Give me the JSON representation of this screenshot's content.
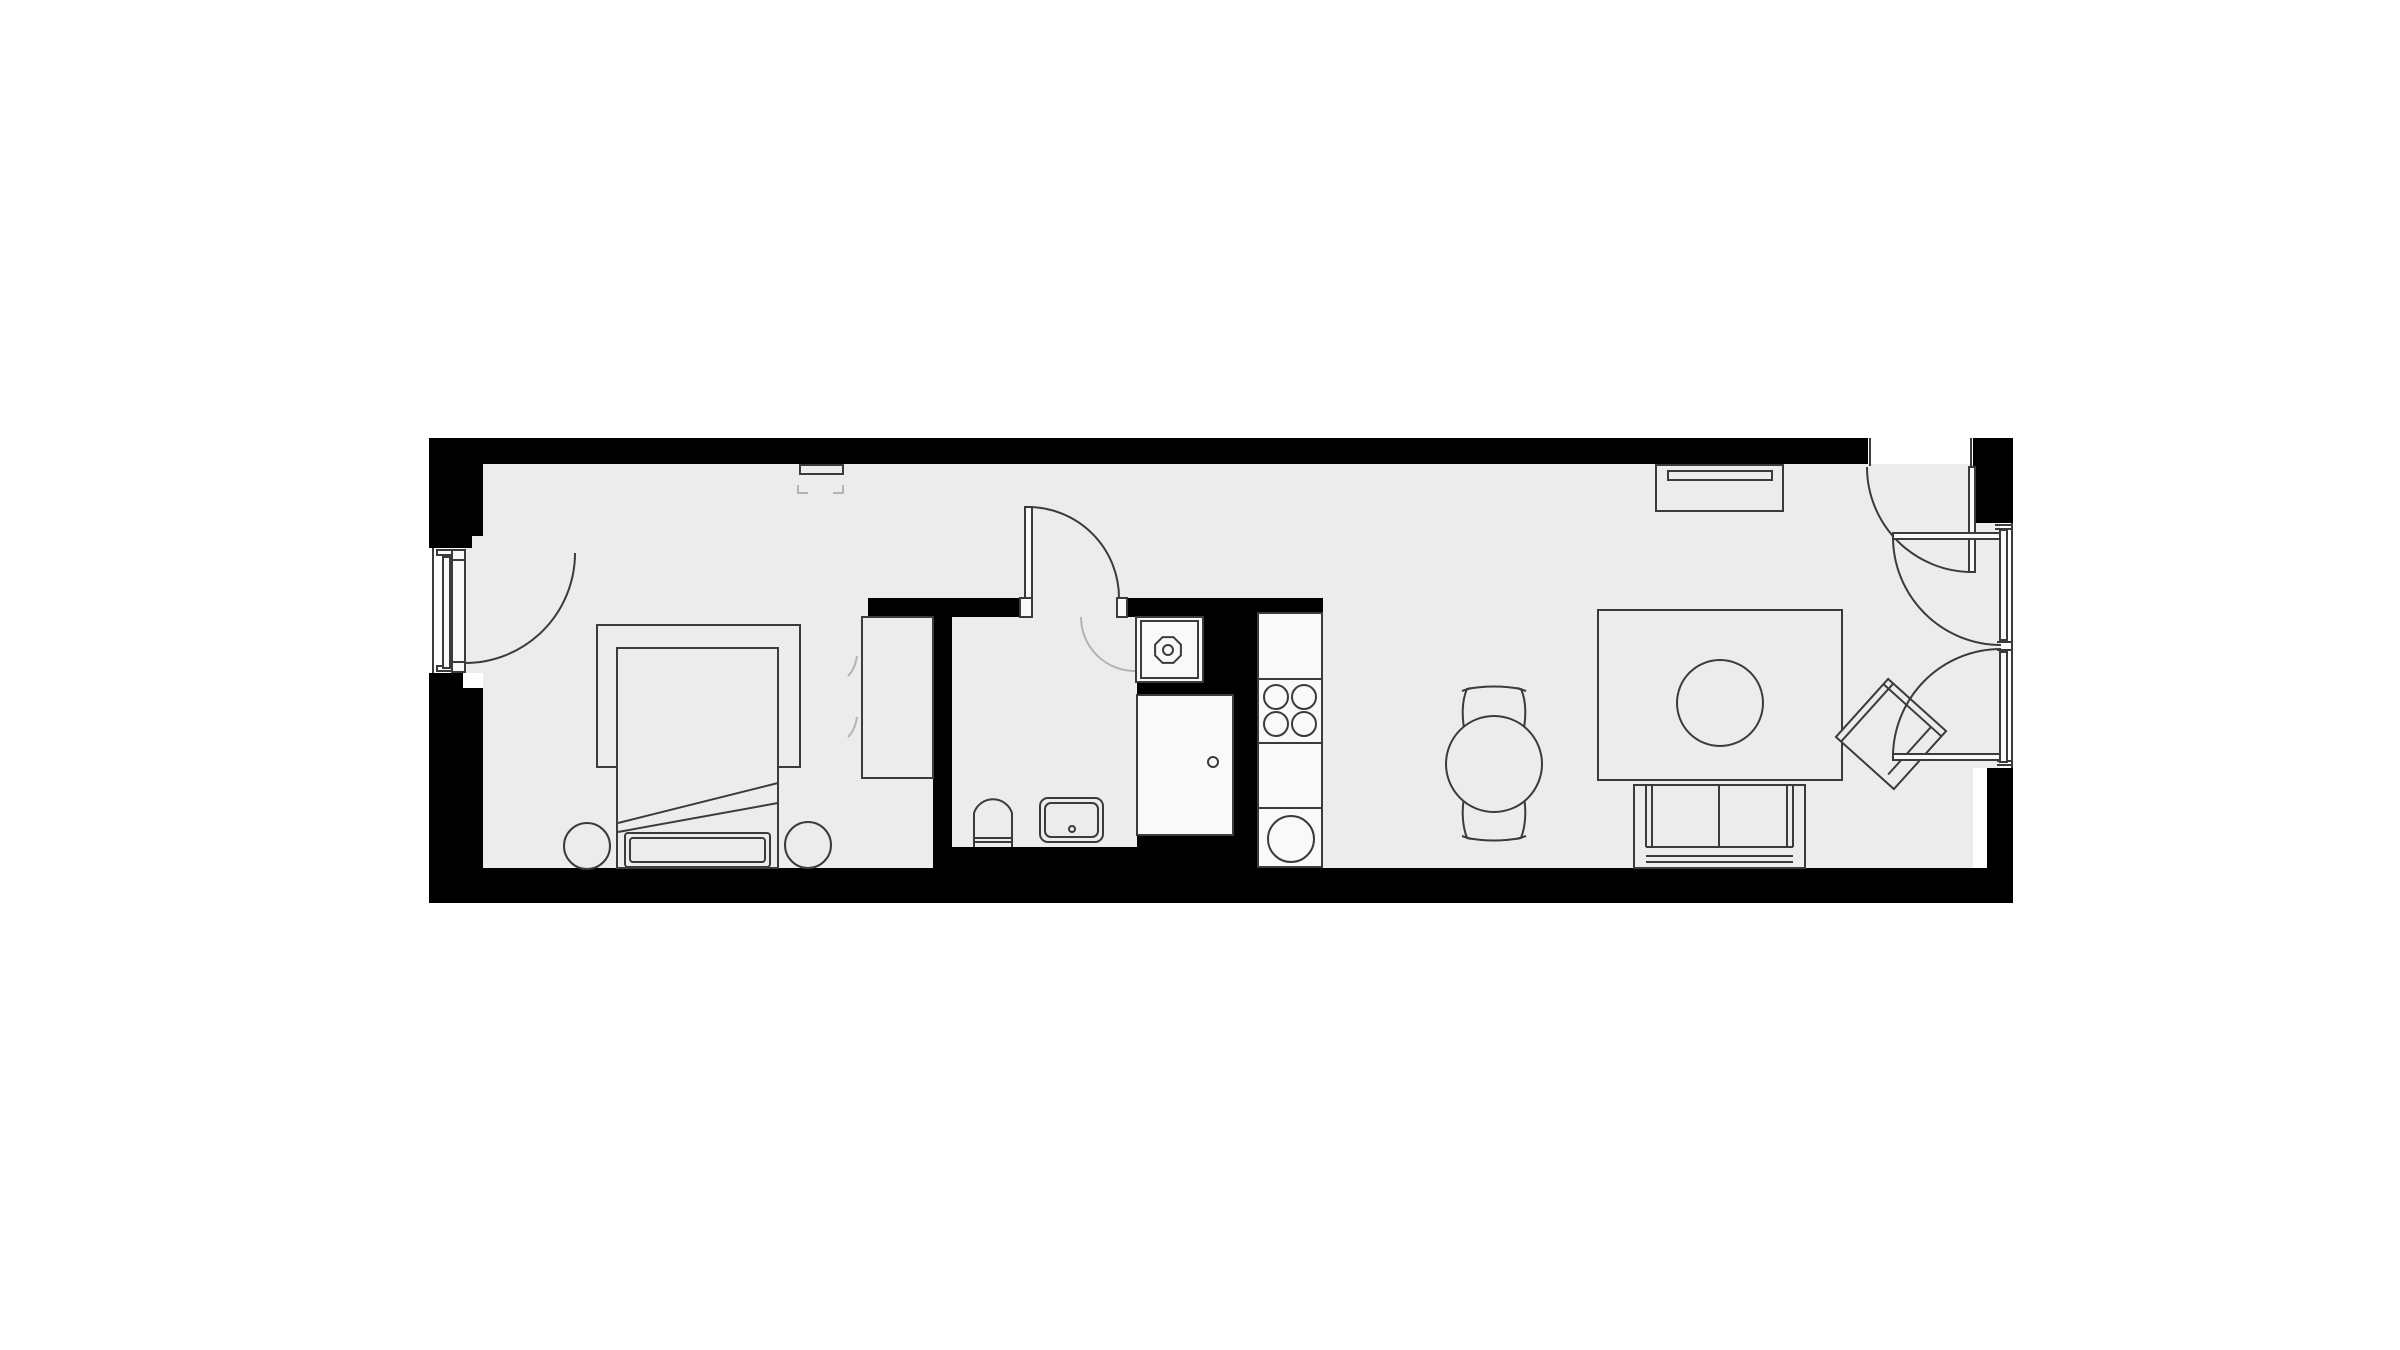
{
  "colors": {
    "background": "#ffffff",
    "wall": "#000000",
    "floor": "#ececec",
    "fixture": "#f9f9f9",
    "line": "#3b3b3b",
    "linelight": "#b3b3b3"
  },
  "plan": {
    "kind": "studio-apartment-floor-plan",
    "orientation": "long narrow unit, entrance on left, balcony doors on right",
    "rooms": [
      {
        "name": "bedroom",
        "furniture": [
          "double-bed-mattress",
          "folded-duvet",
          "pillow",
          "bed-rug",
          "round-stool-left",
          "round-stool-right",
          "wardrobe",
          "wall-tv-bracket"
        ]
      },
      {
        "name": "bathroom",
        "furniture": [
          "toilet",
          "washbasin",
          "washing-machine"
        ]
      },
      {
        "name": "kitchen",
        "furniture": [
          "tall-cabinet-fridge",
          "kitchen-counter",
          "cooktop-four-burners",
          "round-kitchen-sink"
        ]
      },
      {
        "name": "dining-area",
        "furniture": [
          "round-dining-table",
          "dining-chair-north",
          "dining-chair-south"
        ]
      },
      {
        "name": "living-room",
        "furniture": [
          "area-rug",
          "round-coffee-table",
          "two-seat-sofa",
          "rotated-armchair",
          "tv-sideboard"
        ]
      }
    ],
    "doors": [
      {
        "name": "entrance-door",
        "location": "left wall",
        "swing": "inward"
      },
      {
        "name": "bathroom-door",
        "location": "bathroom north wall",
        "swing": "into hall"
      },
      {
        "name": "balcony-door-top",
        "location": "top wall right end",
        "swing": "inward"
      },
      {
        "name": "balcony-door-right-upper",
        "location": "right wall",
        "swing": "inward"
      },
      {
        "name": "balcony-door-right-lower",
        "location": "right wall",
        "swing": "inward"
      }
    ],
    "windows": [
      "entrance-sidelight-glazing",
      "right-wall-glazing-upper",
      "right-wall-glazing-lower"
    ]
  }
}
